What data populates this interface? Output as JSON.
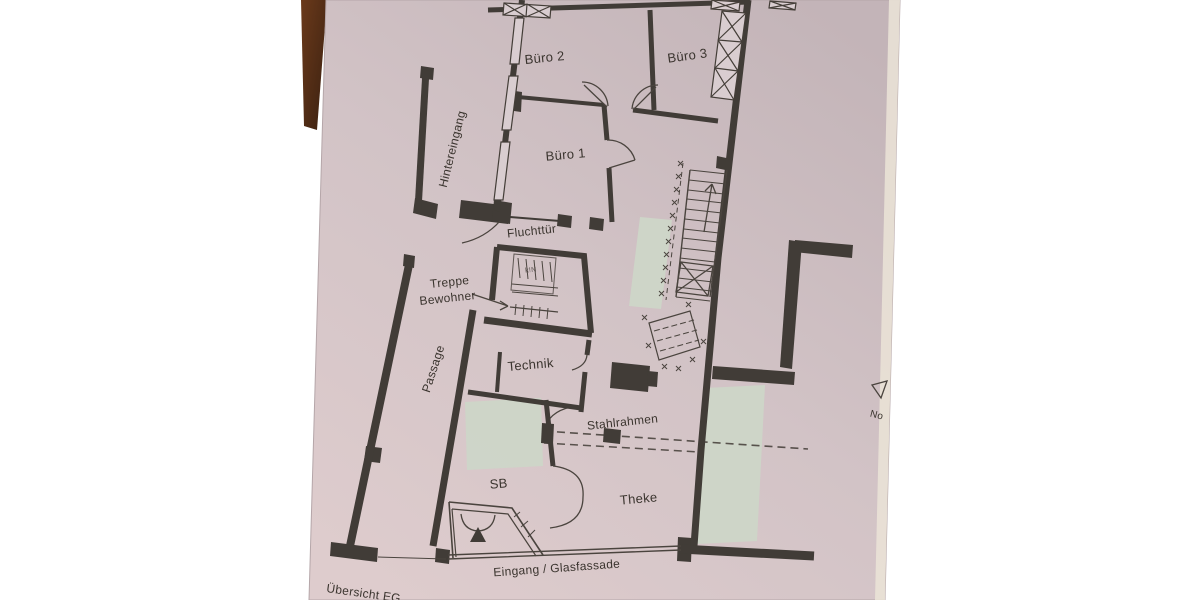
{
  "meta": {
    "description": "Photographed printed floor plan sheet lying on a dark wooden table",
    "sheet_title": "Übersicht EG"
  },
  "colors": {
    "background": "#ffffff",
    "wood_dark": "#3a2010",
    "wood_light": "#6b3a1b",
    "paper_top": "#c3b4b8",
    "paper_mid": "#d2c3c6",
    "paper_bottom": "#decccd",
    "paper_edge_band": "#ebe4d7",
    "wall": "#413c37",
    "thin_line": "#4a443e",
    "highlight_green": "#cdd6c8",
    "text": "#3a342e"
  },
  "labels": {
    "buero2": "Büro 2",
    "buero3": "Büro 3",
    "buero1": "Büro 1",
    "hintereingang": "Hintereingang",
    "fluchttuer": "Fluchttür",
    "treppe_line1": "Treppe",
    "treppe_line2": "Bewohner",
    "passage": "Passage",
    "technik": "Technik",
    "stahlrahmen": "Stahlrahmen",
    "sb": "SB",
    "theke": "Theke",
    "eingang": "Eingang / Glasfassade",
    "uebersicht": "Übersicht EG"
  },
  "annotations": {
    "north_partial": "No",
    "stair_note": "k!N"
  }
}
